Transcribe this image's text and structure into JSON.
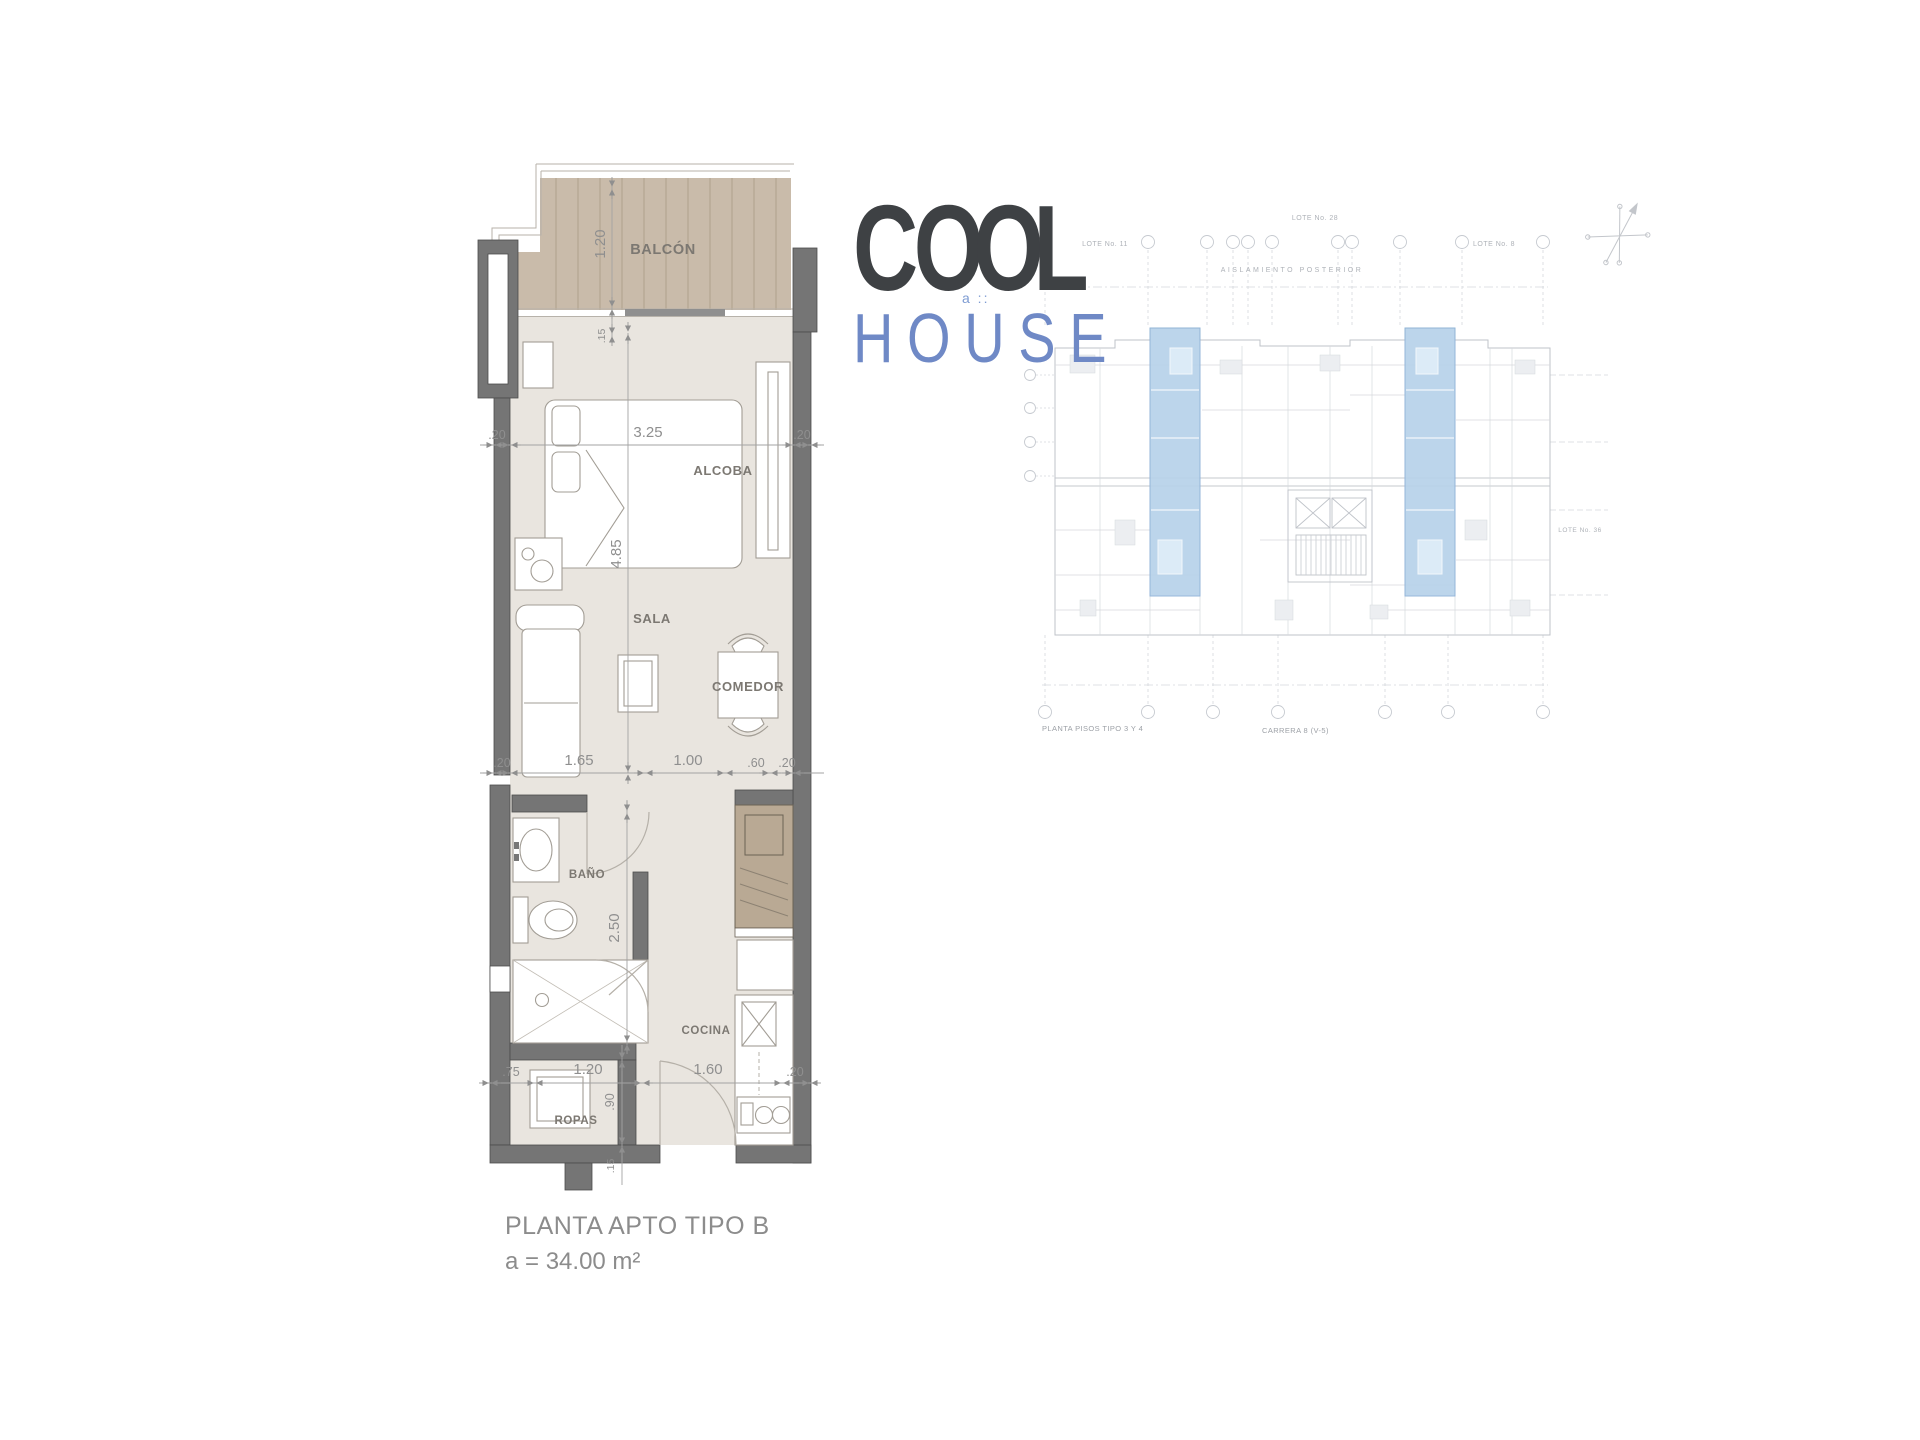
{
  "logo": {
    "word_top": "COOL",
    "word_bottom": "HOUSE",
    "mark": "a ::"
  },
  "plan": {
    "labels": {
      "balcony": "BALCÓN",
      "bedroom": "ALCOBA",
      "living": "SALA",
      "dining": "COMEDOR",
      "bathroom": "BAÑO",
      "kitchen": "COCINA",
      "laundry": "ROPAS"
    },
    "dims": {
      "balcony_depth": "1.20",
      "balcony_edge": ".15",
      "bedroom_left": ".20",
      "bedroom_width": "3.25",
      "bedroom_right": ".20",
      "length": "4.85",
      "living_left": ".20",
      "living_sofa": "1.65",
      "living_mid": "1.00",
      "living_win": ".60",
      "living_right": ".20",
      "bath_length": "2.50",
      "entry_left": ".75",
      "laundry_width": "1.20",
      "entry_door": "1.60",
      "entry_right": ".20",
      "laundry_depth": ".90",
      "laundry_edge": ".15"
    },
    "caption_title": "PLANTA APTO TIPO B",
    "caption_area": "a = 34.00 m²"
  },
  "site": {
    "label_top_left": "LOTE No. 11",
    "label_top_center": "LOTE No. 28",
    "label_top_right": "LOTE No. 8",
    "label_rear": "AISLAMIENTO POSTERIOR",
    "label_right": "LOTE No. 36",
    "label_bottom_left": "PLANTA PISOS TIPO 3 Y 4",
    "label_bottom_center": "CARRERA 8  (V-5)"
  },
  "colors": {
    "logo_dark": "#3e4144",
    "logo_blue": "#6f89c6",
    "unit_highlight": "#b7d2ea",
    "deck": "#c9bbaa",
    "wall": "#757575",
    "floor": "#e9e5df"
  }
}
